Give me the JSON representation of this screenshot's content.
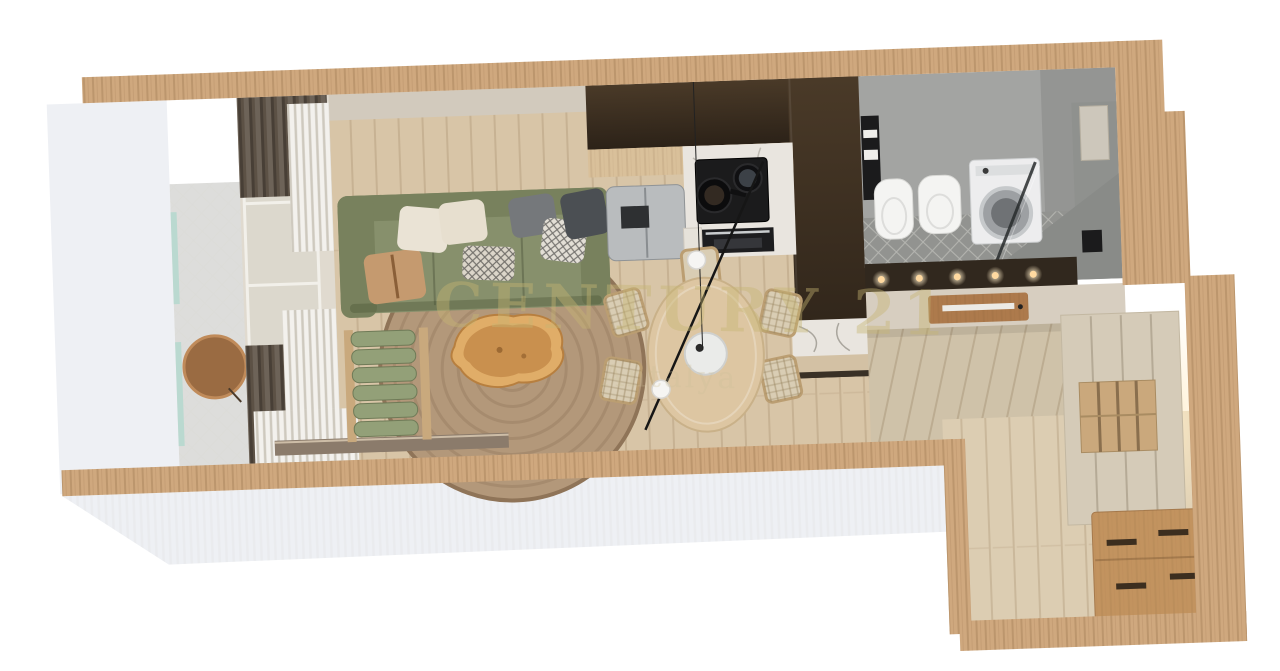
{
  "watermark": {
    "title": "CENTURY 21",
    "subtitle": "Antalya"
  },
  "scene": {
    "type": "3d-floor-plan-render",
    "view": "top-down",
    "rooms": {
      "living_room": [
        "green-sofa",
        "seven-throw-pillows",
        "round-jute-rug",
        "live-edge-coffee-table",
        "rolled-lounge-chair",
        "sheer-curtains",
        "dark-drapes",
        "window-wall",
        "media-shelf"
      ],
      "balcony": [
        "stone-floor",
        "glass-railing",
        "round-side-table"
      ],
      "kitchen": [
        "dark-tall-cabinets",
        "stainless-fridge",
        "marble-counter",
        "gas-cooktop-two-pans",
        "oven",
        "peninsula-with-marble-end"
      ],
      "dining": [
        "oval-wood-table",
        "woven-chairs",
        "linear-pendant-two-globes",
        "serving-disk"
      ],
      "bathroom": [
        "wall-hung-toilet",
        "bidet",
        "washing-machine",
        "glass-shower-screen",
        "black-towel-ladder",
        "marble-walls",
        "wall-niche",
        "vanity-spotlights",
        "wood-door-with-glass-strip"
      ],
      "hallway": [
        "diagonal-plank-floor"
      ],
      "entry": [
        "cream-wardrobe",
        "open-shelf-niche",
        "wood-chest-of-drawers",
        "warm-cove-light"
      ]
    }
  },
  "colors": {
    "wall_wood": "#cfa87e",
    "wall_white": "#eef0f4",
    "wall_face": "#d2cabd",
    "floor_living": "#d8c5a7",
    "floor_hall": "#cfc2a9",
    "floor_entry": "#dccdb2",
    "floor_balcony": "#dddddb",
    "floor_bath": "#a3a4a2",
    "floor_bath_mosaic": "#929390",
    "marble_white": "#e9e5df",
    "marble_gray": "#8f918e",
    "kitchen_dark": "#31281e",
    "counter_wood": "#d9c09a",
    "sofa_green": "#87906c",
    "sofa_green_dark": "#78815d",
    "lounge_green": "#93a078",
    "rug_jute": "#b3987a",
    "table_wood": "#ddc6a2",
    "chair_weave": "#d9cdb4",
    "coffee_table": "#c9904e",
    "drape_dark": "#5c5145",
    "sheer_white": "#f3f1ed",
    "cream_wall": "#d7cec0",
    "wardrobe_cream": "#d5cbb8",
    "dresser_wood": "#c2935f",
    "door_wood": "#ad7a4c",
    "appliance_steel": "#b9bcbe",
    "appliance_white": "#ededee",
    "fixture_white": "#f4f4f2",
    "accent_black": "#1b1b1c",
    "glass_teal": "#bad9d0",
    "glow_warm": "#ffd9a0",
    "media_shelf": "#8b7b6b",
    "watermark_gold": "#c8b478"
  }
}
